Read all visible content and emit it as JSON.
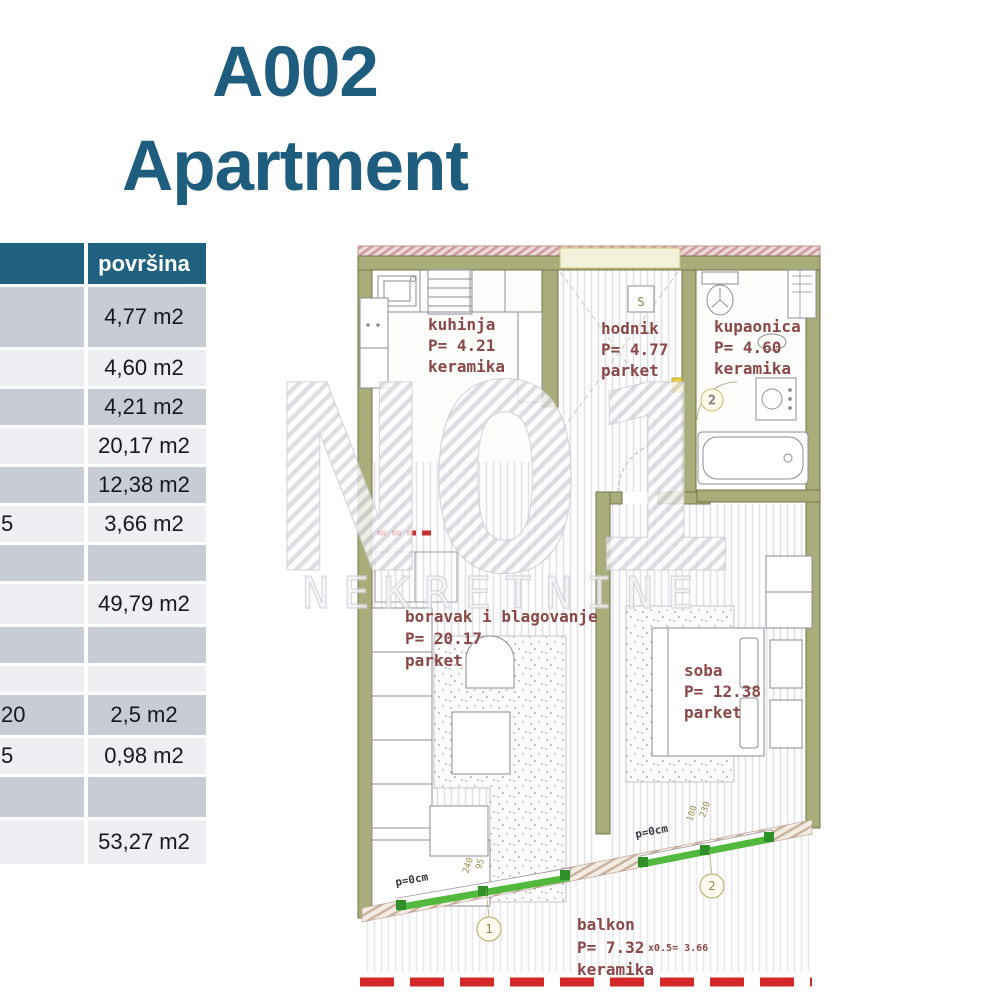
{
  "title": {
    "line1": "A002",
    "line2": "Apartment",
    "color": "#1f5d7e"
  },
  "area_table": {
    "header": {
      "area_col": "površina"
    },
    "header_bg": "#20617f",
    "row_bg_dark": "#c8cdd5",
    "row_bg_light": "#edeff2",
    "rows": [
      {
        "label": "",
        "value": "4,77 m2"
      },
      {
        "label": "",
        "value": "4,60 m2"
      },
      {
        "label": "",
        "value": "4,21 m2"
      },
      {
        "label": "",
        "value": "20,17 m2"
      },
      {
        "label": "",
        "value": "12,38 m2"
      },
      {
        "label": "5",
        "value": "3,66 m2"
      },
      {
        "label": "",
        "value": ""
      },
      {
        "label": "",
        "value": "49,79 m2"
      },
      {
        "label": "",
        "value": ""
      },
      {
        "label": "",
        "value": ""
      },
      {
        "label": "20",
        "value": "2,5 m2"
      },
      {
        "label": "5",
        "value": "0,98 m2"
      },
      {
        "label": "",
        "value": ""
      },
      {
        "label": "",
        "value": "53,27 m2"
      }
    ]
  },
  "floor_plan": {
    "rooms": [
      {
        "name": "kuhinja",
        "area": "P= 4.21",
        "floor": "keramika"
      },
      {
        "name": "hodnik",
        "area": "P= 4.77",
        "floor": "parket"
      },
      {
        "name": "kupaonica",
        "area": "P= 4.60",
        "floor": "keramika"
      },
      {
        "name": "boravak i blagovanje",
        "area": "P= 20.17",
        "floor": "parket"
      },
      {
        "name": "soba",
        "area": "P= 12.38",
        "floor": "parket"
      },
      {
        "name": "balkon",
        "area": "P= 7.32",
        "floor": "keramika",
        "area_note": "x0.5=  3.66"
      }
    ],
    "annotations": {
      "p_label_1": "p=0cm",
      "p_label_2": "p=0cm",
      "door_mark_1": "1",
      "door_mark_2": "2",
      "bath_door_mark": "2",
      "switch_mark": "S",
      "dims_left_a": "240",
      "dims_left_b": "95",
      "dims_right_a": "180",
      "dims_right_b": "230"
    },
    "colors": {
      "wall": "#a9ad7a",
      "label": "#8a4848",
      "sliding_door": "#52b93e",
      "section_line": "#d42828"
    }
  },
  "watermark": {
    "logo": "NO1",
    "subtext": "NEKRETNINE"
  }
}
